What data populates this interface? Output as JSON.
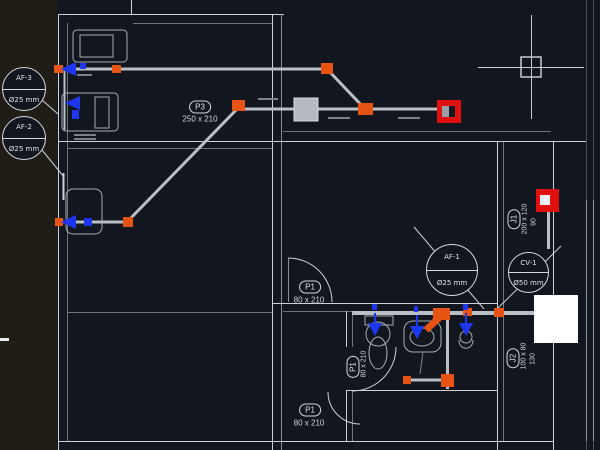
{
  "app": {
    "description": "CAD drawing canvas - floor plan with water supply piping",
    "background": "#12161f",
    "palette_strip_color": "#201c16"
  },
  "colors": {
    "wall": "#ccd2d8",
    "wall_dim": "#6d747c",
    "pipe": "#b9bfc5",
    "fitting_orange": "#e65313",
    "valve_blue": "#1d37f0",
    "selection_red": "#e01010",
    "fan_unit_gray": "#b5bac0",
    "shaft_white": "#ffffff",
    "text": "#dfe3e8"
  },
  "balloons": {
    "af3": {
      "line1": "AF-3",
      "line2": "Ø25 mm"
    },
    "af2": {
      "line1": "AF-2",
      "line2": "Ø25 mm"
    },
    "af1": {
      "line1": "AF-1",
      "line2": "Ø25 mm"
    },
    "cv1": {
      "line1": "CV-1",
      "line2": "Ø50 mm"
    }
  },
  "door_tags": {
    "p3": {
      "label": "P3",
      "size": "250 x 210"
    },
    "p1_living": {
      "label": "P1",
      "size": "80 x 210"
    },
    "p1_bath": {
      "label": "P1",
      "size": "80 x 210"
    },
    "p1_bottom": {
      "label": "P1",
      "size": "80 x 210"
    }
  },
  "window_tags": {
    "j1": {
      "label": "J1",
      "size": "200 x 120",
      "sill": "90"
    },
    "j2": {
      "label": "J2",
      "size": "100 x 80",
      "sill": "130"
    }
  }
}
